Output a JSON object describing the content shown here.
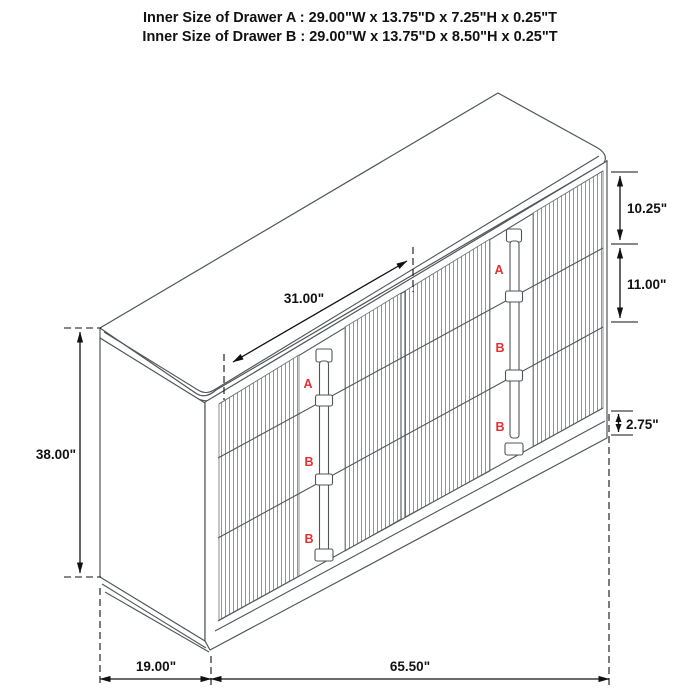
{
  "title": {
    "line1": "Inner Size of Drawer A : 29.00\"W x 13.75\"D x 7.25\"H x 0.25\"T",
    "line2": "Inner Size of Drawer B : 29.00\"W x 13.75\"D x 8.50\"H x 0.25\"T"
  },
  "dimensions": {
    "drawer_width": "31.00\"",
    "drawer_a_height": "10.25\"",
    "drawer_b_height": "11.00\"",
    "base_height": "2.75\"",
    "total_height": "38.00\"",
    "depth": "19.00\"",
    "total_width": "65.50\""
  },
  "drawer_markers": {
    "left_column": [
      "A",
      "B",
      "B"
    ],
    "right_column": [
      "A",
      "B",
      "B"
    ]
  },
  "colors": {
    "outline": "#4f565a",
    "flute_line": "#848b90",
    "dimension": "#111111",
    "marker_red": "#e53030",
    "background": "#ffffff"
  }
}
